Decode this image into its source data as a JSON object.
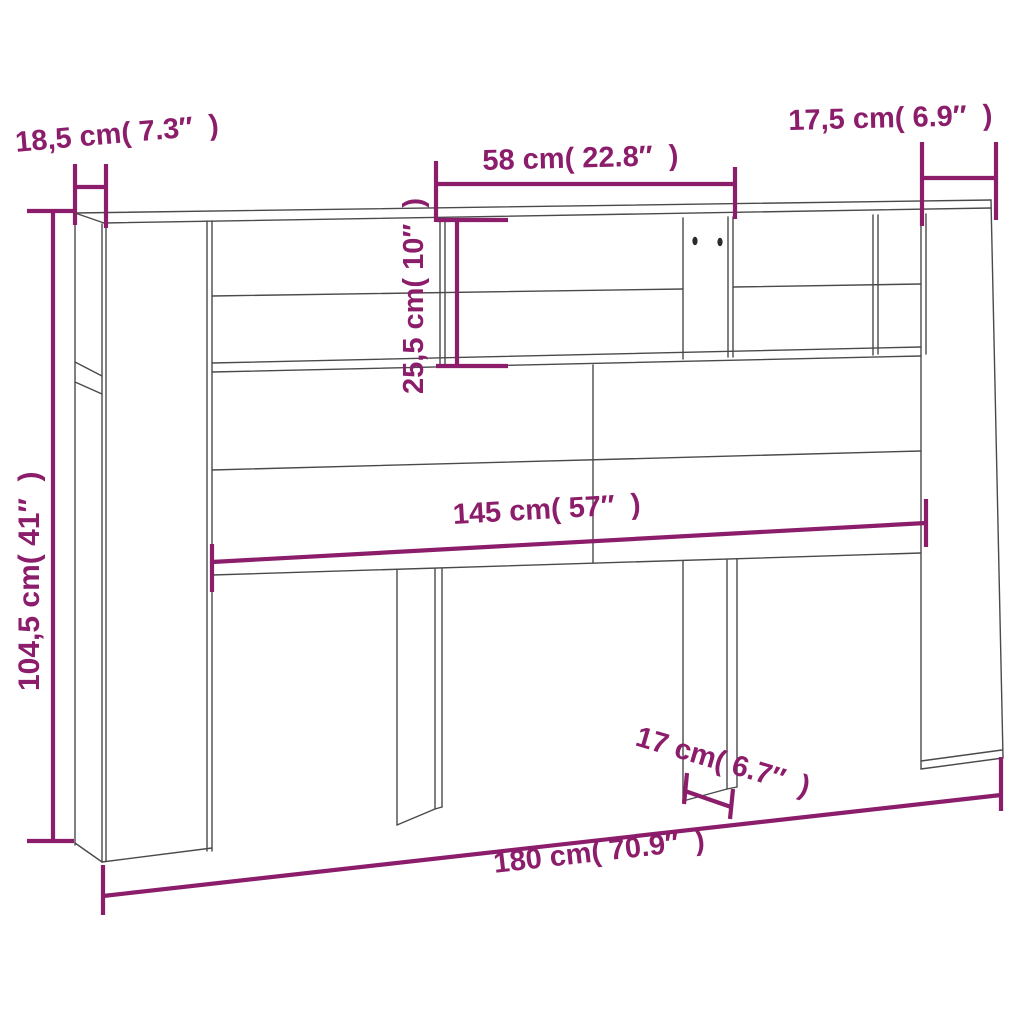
{
  "colors": {
    "dimension_accent": "#8b1d6b",
    "drawing_line": "#4a4a4a",
    "background": "#ffffff"
  },
  "diagram": {
    "subject": "headboard cabinet dimensional drawing",
    "dimensions": {
      "depth_left": {
        "cm": "18,5",
        "inch": "7.3",
        "label": "18,5 cm( 7.3″  )"
      },
      "shelf_width": {
        "cm": "58",
        "inch": "22.8",
        "label": "58 cm( 22.8″  )"
      },
      "depth_right": {
        "cm": "17,5",
        "inch": "6.9",
        "label": "17,5 cm( 6.9″  )"
      },
      "shelf_height": {
        "cm": "25,5",
        "inch": "10",
        "label": "25,5 cm( 10″  )"
      },
      "height": {
        "cm": "104,5",
        "inch": "41",
        "label": "104,5 cm( 41″  )"
      },
      "inner_width": {
        "cm": "145",
        "inch": "57",
        "label": "145 cm( 57″  )"
      },
      "leg_width": {
        "cm": "17",
        "inch": "6.7",
        "label": "17 cm( 6.7″  )"
      },
      "total_width": {
        "cm": "180",
        "inch": "70.9",
        "label": "180 cm( 70.9″  )"
      }
    }
  }
}
